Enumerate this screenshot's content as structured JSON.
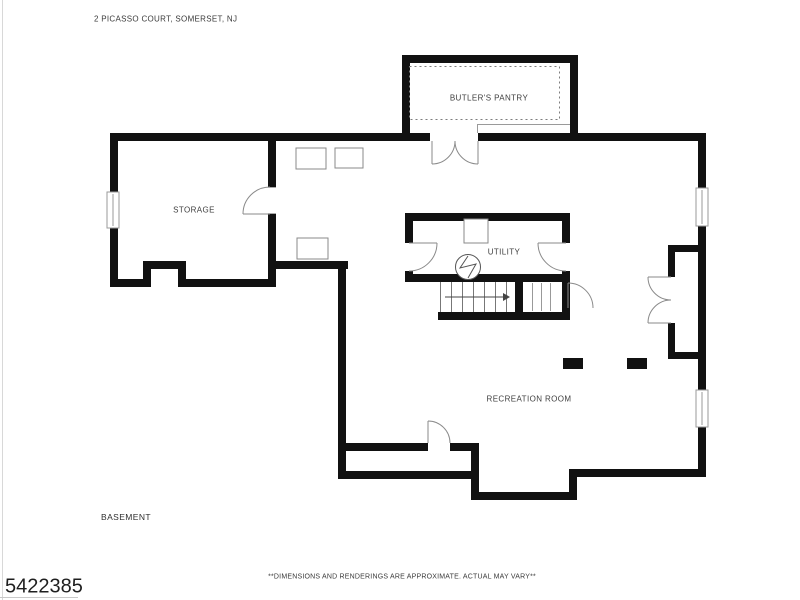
{
  "header": {
    "address": "2 PICASSO COURT, SOMERSET, NJ"
  },
  "rooms": [
    {
      "name": "BUTLER'S PANTRY"
    },
    {
      "name": "STORAGE"
    },
    {
      "name": "UTILITY"
    },
    {
      "name": "RECREATION ROOM"
    }
  ],
  "floor_label": "BASEMENT",
  "disclaimer": "**DIMENSIONS AND RENDERINGS ARE APPROXIMATE. ACTUAL MAY VARY**",
  "mls_number": "5422385",
  "colors": {
    "wall": "#111111",
    "thin_line": "#8a8a8a",
    "text": "#3e3e3e"
  }
}
